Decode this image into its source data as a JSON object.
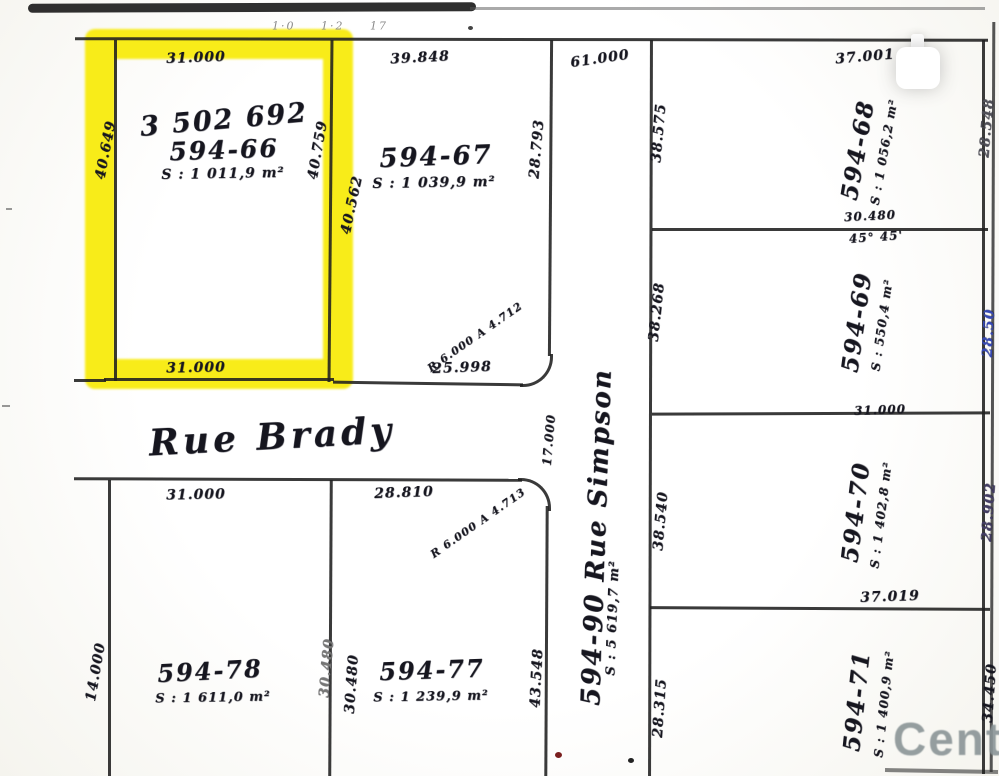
{
  "plan": {
    "top_marks": "1·0  1·2  17",
    "highlight_color": "#f7ea00",
    "streets": {
      "brady": {
        "label": "Rue Brady"
      },
      "simpson": {
        "label": "594-90 Rue Simpson",
        "area": "S : 5 619,7 m²"
      }
    },
    "lots": {
      "l66": {
        "scribble": "3 502 692",
        "number": "594-66",
        "area": "S : 1 011,9 m²"
      },
      "l67": {
        "number": "594-67",
        "area": "S : 1 039,9 m²"
      },
      "l68": {
        "number": "594-68",
        "area": "S : 1 056,2 m²"
      },
      "l69": {
        "number": "594-69",
        "area": "S : 550,4 m²"
      },
      "l70": {
        "number": "594-70",
        "area": "S : 1 402,8 m²"
      },
      "l71": {
        "number": "594-71",
        "area": "S : 1 400,9 m²"
      },
      "l77": {
        "number": "594-77",
        "area": "S : 1 239,9 m²"
      },
      "l78": {
        "number": "594-78",
        "area": "S : 1 611,0 m²"
      }
    },
    "dims": [
      {
        "t": "31.000",
        "x": 196,
        "y": 58,
        "r": -2
      },
      {
        "t": "31.000",
        "x": 196,
        "y": 368,
        "r": -1
      },
      {
        "t": "40.649",
        "x": 106,
        "y": 150,
        "r": -79
      },
      {
        "t": "40.759",
        "x": 318,
        "y": 150,
        "r": -80
      },
      {
        "t": "40.562",
        "x": 352,
        "y": 205,
        "r": -78
      },
      {
        "t": "39.848",
        "x": 420,
        "y": 58,
        "r": -3
      },
      {
        "t": "28.793",
        "x": 537,
        "y": 149,
        "r": -85
      },
      {
        "t": "25.998",
        "x": 462,
        "y": 368,
        "r": -2
      },
      {
        "t": "61.000",
        "x": 600,
        "y": 59,
        "r": -8
      },
      {
        "t": "R 6.000  A 4.712",
        "x": 475,
        "y": 337,
        "r": -35,
        "s": 11
      },
      {
        "t": "R 6.000  A 4.713",
        "x": 478,
        "y": 523,
        "r": -35,
        "s": 11
      },
      {
        "t": "17.000",
        "x": 549,
        "y": 440,
        "r": -85,
        "s": 12
      },
      {
        "t": "31.000",
        "x": 196,
        "y": 495,
        "r": -1
      },
      {
        "t": "28.810",
        "x": 404,
        "y": 493,
        "r": -2
      },
      {
        "t": "14.000",
        "x": 96,
        "y": 672,
        "r": -80
      },
      {
        "t": "30.480",
        "x": 327,
        "y": 668,
        "r": -85,
        "c": "#777776"
      },
      {
        "t": "30.480",
        "x": 352,
        "y": 684,
        "r": -86
      },
      {
        "t": "43.548",
        "x": 537,
        "y": 678,
        "r": -87
      },
      {
        "t": "37.001",
        "x": 865,
        "y": 57,
        "r": -5
      },
      {
        "t": "38.575",
        "x": 659,
        "y": 133,
        "r": -85
      },
      {
        "t": "28.548",
        "x": 987,
        "y": 128,
        "r": -85,
        "c": "#55555c"
      },
      {
        "t": "30.480",
        "x": 870,
        "y": 216,
        "r": -3,
        "s": 12
      },
      {
        "t": "45° 45'",
        "x": 876,
        "y": 237,
        "r": -4,
        "s": 12
      },
      {
        "t": "38.268",
        "x": 657,
        "y": 312,
        "r": -84
      },
      {
        "t": "28.50",
        "x": 989,
        "y": 333,
        "r": -87,
        "c": "#3f4fae"
      },
      {
        "t": "31.000",
        "x": 880,
        "y": 410,
        "r": -2,
        "s": 12
      },
      {
        "t": "38.540",
        "x": 661,
        "y": 521,
        "r": -85
      },
      {
        "t": "28.902",
        "x": 989,
        "y": 512,
        "r": -86,
        "c": "#4a4466"
      },
      {
        "t": "37.019",
        "x": 890,
        "y": 597,
        "r": -2
      },
      {
        "t": "28.315",
        "x": 660,
        "y": 708,
        "r": -86
      },
      {
        "t": "34.450",
        "x": 990,
        "y": 693,
        "r": -86
      }
    ],
    "watermark": {
      "text": "Centi"
    }
  }
}
